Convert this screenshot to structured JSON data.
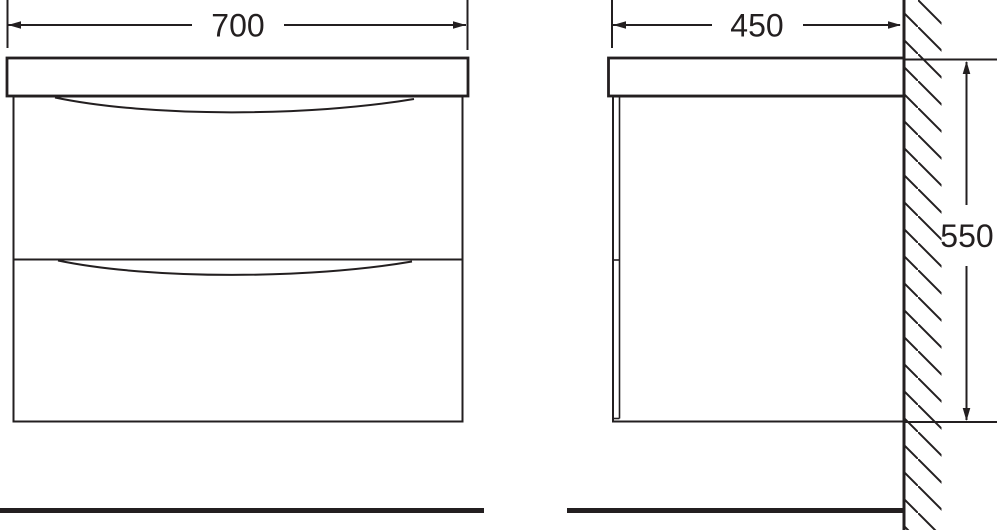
{
  "drawing": {
    "background_color": "#ffffff",
    "line_color": "#231f20",
    "front_view": {
      "width_dimension": {
        "label": "700"
      }
    },
    "side_view": {
      "depth_dimension": {
        "label": "450"
      },
      "height_dimension": {
        "label": "550"
      }
    }
  }
}
